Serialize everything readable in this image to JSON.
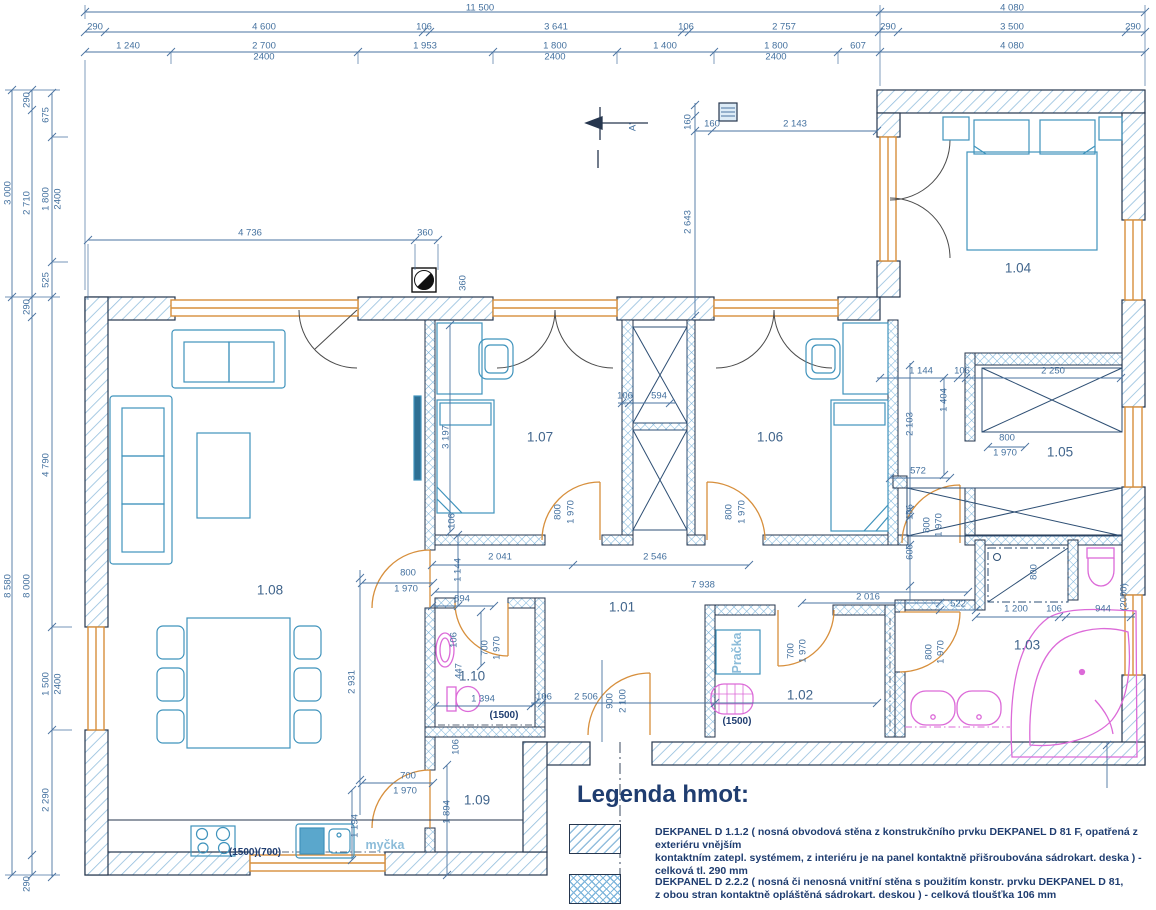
{
  "legend": {
    "title": "Legenda hmot:",
    "items": [
      {
        "pattern": "diagonal-hatch",
        "line1": "DEKPANEL D 1.1.2 ( nosná obvodová stěna z konstrukčního prvku DEKPANEL D 81 F, opatřená z exteriéru vnějším",
        "line2": "kontaktním zatepl. systémem, z interiéru je na panel kontaktně přišroubována sádrokart. deska ) - celková tl. 290 mm"
      },
      {
        "pattern": "cross-hatch",
        "line1": "DEKPANEL D 2.2.2 ( nosná či nenosná vnitřní stěna s použitím konstr. prvku DEKPANEL D 81,",
        "line2": "z obou stran kontaktně opláštěná sádrokart. deskou ) - celková tloušťka 106 mm"
      }
    ]
  },
  "colors": {
    "wall_outline": "#26364e",
    "exterior_hatch": "#93bedd",
    "interior_hatch": "#7fb6dc",
    "window_door": "#d78f3c",
    "furniture": "#3f93bc",
    "sanitary": "#dc6ad8",
    "dimension": "#4a73a1",
    "legend_text": "#1f3d70"
  },
  "rooms": [
    "1.01",
    "1.02",
    "1.03",
    "1.04",
    "1.05",
    "1.06",
    "1.07",
    "1.08",
    "1.09",
    "1.10"
  ],
  "labels": [
    {
      "t": "11 500",
      "x": 480,
      "y": 8
    },
    {
      "t": "4 080",
      "x": 1012,
      "y": 8
    },
    {
      "t": "290",
      "x": 95,
      "y": 27
    },
    {
      "t": "4 600",
      "x": 264,
      "y": 27
    },
    {
      "t": "106",
      "x": 424,
      "y": 27
    },
    {
      "t": "3 641",
      "x": 556,
      "y": 27
    },
    {
      "t": "106",
      "x": 686,
      "y": 27
    },
    {
      "t": "2 757",
      "x": 784,
      "y": 27
    },
    {
      "t": "290",
      "x": 888,
      "y": 27
    },
    {
      "t": "3 500",
      "x": 1012,
      "y": 27
    },
    {
      "t": "290",
      "x": 1133,
      "y": 27
    },
    {
      "t": "1 240",
      "x": 128,
      "y": 46
    },
    {
      "t": "2 700",
      "x": 264,
      "y": 46
    },
    {
      "t": "1 953",
      "x": 425,
      "y": 46
    },
    {
      "t": "1 800",
      "x": 555,
      "y": 46
    },
    {
      "t": "1 400",
      "x": 665,
      "y": 46
    },
    {
      "t": "1 800",
      "x": 776,
      "y": 46
    },
    {
      "t": "607",
      "x": 858,
      "y": 46
    },
    {
      "t": "4 080",
      "x": 1012,
      "y": 46
    },
    {
      "t": "2400",
      "x": 264,
      "y": 57
    },
    {
      "t": "2400",
      "x": 555,
      "y": 57
    },
    {
      "t": "2400",
      "x": 776,
      "y": 57
    },
    {
      "t": "3 000",
      "x": 8,
      "y": 193,
      "r": 1
    },
    {
      "t": "8 580",
      "x": 8,
      "y": 586,
      "r": 1
    },
    {
      "t": "290",
      "x": 27,
      "y": 100,
      "r": 1
    },
    {
      "t": "2 710",
      "x": 27,
      "y": 203,
      "r": 1
    },
    {
      "t": "290",
      "x": 27,
      "y": 307,
      "r": 1
    },
    {
      "t": "8 000",
      "x": 27,
      "y": 586,
      "r": 1
    },
    {
      "t": "290",
      "x": 27,
      "y": 884,
      "r": 1
    },
    {
      "t": "675",
      "x": 46,
      "y": 115,
      "r": 1
    },
    {
      "t": "1 800",
      "x": 46,
      "y": 199,
      "r": 1
    },
    {
      "t": "525",
      "x": 46,
      "y": 280,
      "r": 1
    },
    {
      "t": "4 790",
      "x": 46,
      "y": 465,
      "r": 1
    },
    {
      "t": "1 500",
      "x": 46,
      "y": 684,
      "r": 1
    },
    {
      "t": "2 290",
      "x": 46,
      "y": 800,
      "r": 1
    },
    {
      "t": "2400",
      "x": 58,
      "y": 199,
      "r": 1
    },
    {
      "t": "2400",
      "x": 58,
      "y": 684,
      "r": 1
    },
    {
      "t": "4 736",
      "x": 250,
      "y": 233
    },
    {
      "t": "360",
      "x": 425,
      "y": 233
    },
    {
      "t": "360",
      "x": 463,
      "y": 283,
      "r": 1
    },
    {
      "t": "160",
      "x": 688,
      "y": 122,
      "r": 1
    },
    {
      "t": "160",
      "x": 712,
      "y": 124
    },
    {
      "t": "2 143",
      "x": 795,
      "y": 124
    },
    {
      "t": "2 643",
      "x": 688,
      "y": 222,
      "r": 1
    },
    {
      "t": "A'",
      "x": 633,
      "y": 127,
      "r": 1
    },
    {
      "t": "1.07",
      "x": 540,
      "y": 437,
      "c": "r"
    },
    {
      "t": "1.06",
      "x": 770,
      "y": 437,
      "c": "r"
    },
    {
      "t": "1.08",
      "x": 270,
      "y": 590,
      "c": "r"
    },
    {
      "t": "1.01",
      "x": 622,
      "y": 607,
      "c": "r"
    },
    {
      "t": "1.04",
      "x": 1018,
      "y": 268,
      "c": "r"
    },
    {
      "t": "1.05",
      "x": 1060,
      "y": 452,
      "c": "r"
    },
    {
      "t": "1.03",
      "x": 1027,
      "y": 645,
      "c": "r"
    },
    {
      "t": "1.02",
      "x": 800,
      "y": 695,
      "c": "r"
    },
    {
      "t": "1.10",
      "x": 472,
      "y": 676,
      "c": "r"
    },
    {
      "t": "1.09",
      "x": 477,
      "y": 800,
      "c": "r"
    },
    {
      "t": "3 197",
      "x": 446,
      "y": 437,
      "r": 1
    },
    {
      "t": "106",
      "x": 452,
      "y": 521,
      "r": 1
    },
    {
      "t": "106",
      "x": 625,
      "y": 396
    },
    {
      "t": "594",
      "x": 659,
      "y": 396
    },
    {
      "t": "800",
      "x": 558,
      "y": 512,
      "r": 1
    },
    {
      "t": "1 970",
      "x": 571,
      "y": 512,
      "r": 1
    },
    {
      "t": "800",
      "x": 729,
      "y": 512,
      "r": 1
    },
    {
      "t": "1 970",
      "x": 742,
      "y": 512,
      "r": 1
    },
    {
      "t": "2 041",
      "x": 500,
      "y": 557
    },
    {
      "t": "2 546",
      "x": 655,
      "y": 557
    },
    {
      "t": "1 144",
      "x": 458,
      "y": 570,
      "r": 1
    },
    {
      "t": "800",
      "x": 408,
      "y": 573
    },
    {
      "t": "1 970",
      "x": 406,
      "y": 589
    },
    {
      "t": "7 938",
      "x": 703,
      "y": 585
    },
    {
      "t": "894",
      "x": 462,
      "y": 599
    },
    {
      "t": "2 931",
      "x": 352,
      "y": 682,
      "r": 1
    },
    {
      "t": "700",
      "x": 485,
      "y": 648,
      "r": 1
    },
    {
      "t": "1 970",
      "x": 497,
      "y": 648,
      "r": 1
    },
    {
      "t": "106",
      "x": 454,
      "y": 640,
      "r": 1
    },
    {
      "t": "447",
      "x": 459,
      "y": 671,
      "r": 1
    },
    {
      "t": "1 394",
      "x": 483,
      "y": 699
    },
    {
      "t": "(1500)",
      "x": 504,
      "y": 716,
      "c": "n"
    },
    {
      "t": "106",
      "x": 544,
      "y": 697
    },
    {
      "t": "2 506",
      "x": 586,
      "y": 697
    },
    {
      "t": "900",
      "x": 610,
      "y": 701,
      "r": 1
    },
    {
      "t": "2 100",
      "x": 623,
      "y": 701,
      "r": 1
    },
    {
      "t": "106",
      "x": 456,
      "y": 747,
      "r": 1
    },
    {
      "t": "700",
      "x": 408,
      "y": 776
    },
    {
      "t": "1 970",
      "x": 405,
      "y": 791
    },
    {
      "t": "1 894",
      "x": 447,
      "y": 812,
      "r": 1
    },
    {
      "t": "1 194",
      "x": 355,
      "y": 826,
      "r": 1
    },
    {
      "t": "(1500)(700)",
      "x": 255,
      "y": 853,
      "c": "n"
    },
    {
      "t": "myčka",
      "x": 385,
      "y": 845,
      "c": "f"
    },
    {
      "t": "Pračka",
      "x": 737,
      "y": 653,
      "r": 1,
      "c": "f"
    },
    {
      "t": "(1500)",
      "x": 737,
      "y": 722,
      "c": "n"
    },
    {
      "t": "700",
      "x": 791,
      "y": 651,
      "r": 1
    },
    {
      "t": "1 970",
      "x": 803,
      "y": 651,
      "r": 1
    },
    {
      "t": "2 016",
      "x": 868,
      "y": 597
    },
    {
      "t": "1 144",
      "x": 921,
      "y": 371
    },
    {
      "t": "106",
      "x": 962,
      "y": 371
    },
    {
      "t": "2 250",
      "x": 1053,
      "y": 371
    },
    {
      "t": "2 103",
      "x": 910,
      "y": 424,
      "r": 1
    },
    {
      "t": "1 404",
      "x": 944,
      "y": 400,
      "r": 1
    },
    {
      "t": "800",
      "x": 1007,
      "y": 438
    },
    {
      "t": "1 970",
      "x": 1005,
      "y": 453
    },
    {
      "t": "572",
      "x": 918,
      "y": 471
    },
    {
      "t": "106",
      "x": 910,
      "y": 512,
      "r": 1
    },
    {
      "t": "800",
      "x": 927,
      "y": 525,
      "r": 1
    },
    {
      "t": "1 970",
      "x": 939,
      "y": 525,
      "r": 1
    },
    {
      "t": "600",
      "x": 910,
      "y": 552,
      "r": 1
    },
    {
      "t": "800",
      "x": 1034,
      "y": 572,
      "r": 1
    },
    {
      "t": "522",
      "x": 958,
      "y": 604
    },
    {
      "t": "1 200",
      "x": 1016,
      "y": 609
    },
    {
      "t": "106",
      "x": 1054,
      "y": 609
    },
    {
      "t": "944",
      "x": 1103,
      "y": 609
    },
    {
      "t": "(2000)",
      "x": 1124,
      "y": 597,
      "r": 1
    },
    {
      "t": "800",
      "x": 929,
      "y": 652,
      "r": 1
    },
    {
      "t": "1 970",
      "x": 941,
      "y": 652,
      "r": 1
    }
  ]
}
